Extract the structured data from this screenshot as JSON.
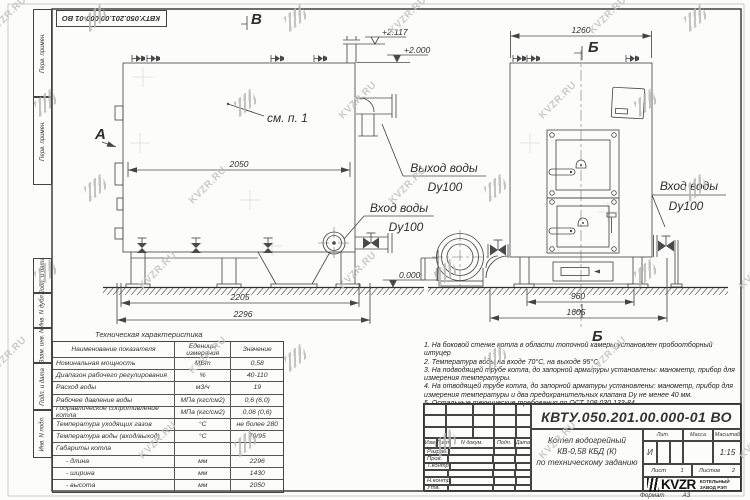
{
  "stamp_top": "КВТУ.050.201.00.000-01 ВО",
  "margin_boxes": [
    "Перв. примен.",
    "Перв. примен.",
    "Подп. и дата",
    "Инв. N дубл.",
    "Взам. инв. N",
    "Подп. и дата",
    "Инв. N подл."
  ],
  "drawing": {
    "view_labels": {
      "a": "А",
      "b": "В",
      "section": "Б"
    },
    "see_note": "см. п. 1",
    "dims": {
      "d2050": "2050",
      "d2205": "2205",
      "d2296": "2296",
      "d1260": "1260",
      "d960": "960",
      "d1605": "1605"
    },
    "elevations": {
      "top": "+2.117",
      "mid": "+2.000",
      "zero": "0.000"
    },
    "labels": {
      "outlet_1": "Выход воды",
      "outlet_2": "Dy100",
      "inlet_1": "Вход воды",
      "inlet_2": "Dy100",
      "inlet_right_1": "Вход воды",
      "inlet_right_2": "Dy100"
    }
  },
  "spec_table": {
    "title": "Техническая характеристика",
    "headers": [
      "Наименование показателя",
      "Еденицы измерения",
      "Значение"
    ],
    "rows": [
      [
        "Номинальная мощность",
        "МВт",
        "0,58"
      ],
      [
        "Диапазон рабочего регулирования",
        "%",
        "40-110"
      ],
      [
        "Расход воды",
        "м3/ч",
        "19"
      ],
      [
        "Рабочее давление воды",
        "МПа (кгс/см2)",
        "0,6 (6,0)"
      ],
      [
        "Гидравлическое сопротивление котла",
        "МПа (кгс/см2)",
        "0,06 (0,6)"
      ],
      [
        "Температура уходящих газов",
        "°С",
        "не более 280"
      ],
      [
        "Температура воды (вход/выход)",
        "°С",
        "70/95"
      ],
      [
        "Габариты котла",
        "",
        ""
      ],
      [
        "- длина",
        "мм",
        "2296"
      ],
      [
        "- ширина",
        "мм",
        "1430"
      ],
      [
        "- высота",
        "мм",
        "2050"
      ]
    ]
  },
  "notes": [
    "1.  На боковой стенке котла в области топочной камеры установлен пробоотборный штуцер",
    "2.  Температура воды на входе 70°С, на выходе 95°С.",
    "3.  На подводящей трубе котла, до запорной арматуры установлены: манометр, прибор для измерения температуры.",
    "4.  На отводящей трубе котла, до запорной арматуры установлены: манометр, прибор для измерения температуры и два предохранительных клапана Dу не менее 40 мм.",
    "5.  Остальные технические требования по ОСТ 108.030.133-84."
  ],
  "title_block": {
    "doc_number": "КВТУ.050.201.00.000-01 ВО",
    "cols": [
      "Изм.",
      "Лист",
      "N докум.",
      "Подп.",
      "Дата"
    ],
    "rows": [
      "Разраб.",
      "Пров.",
      "Т.контр.",
      "",
      "Н.контр.",
      "Утв."
    ],
    "product": [
      "Котел водогрейный",
      "КВ-0,58 КБД (К)",
      "по техническому заданию"
    ],
    "lit_header": "Лит.",
    "mass_header": "Масса",
    "scale_header": "Масштаб",
    "lit": "И",
    "scale": "1:15",
    "sheet_label": "Лист",
    "sheet_value": "1",
    "sheets_label": "Листов",
    "sheets_value": "2",
    "logo_text": "KVZR",
    "org_line1": "КОТЕЛЬНЫЙ",
    "org_line2": "ЗАВОД РЭП",
    "format_label": "Формат",
    "format_value": "А3"
  },
  "watermark": {
    "text": "KVZR.RU"
  }
}
